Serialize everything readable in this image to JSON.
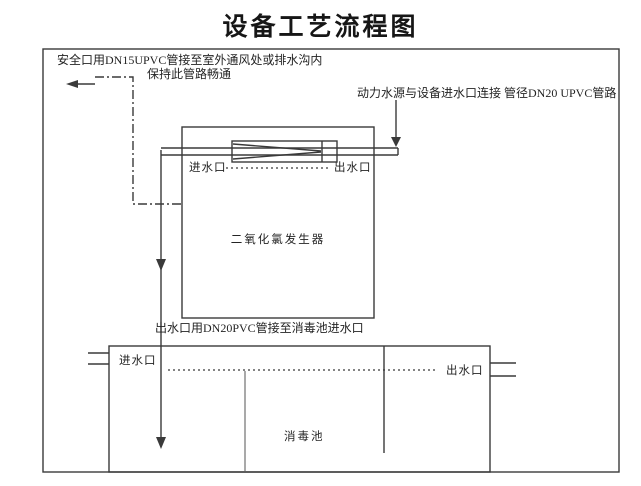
{
  "title": "设备工艺流程图",
  "annotations": {
    "safety_line1": "安全口用DN15UPVC管接至室外通风处或排水沟内",
    "safety_line2": "保持此管路畅通",
    "supply_line": "动力水源与设备进水口连接 管径DN20 UPVC管路",
    "outlet_pipe": "出水口用DN20PVC管接至消毒池进水口"
  },
  "generator": {
    "label": "二氧化氯发生器",
    "inlet_label": "进水口",
    "outlet_label": "出水口"
  },
  "pool": {
    "label": "消毒池",
    "inlet_label": "进水口",
    "outlet_label": "出水口"
  },
  "colors": {
    "line": "#3a3a3a",
    "baffle_gray": "#a9a9a9",
    "text": "#242424",
    "background": "#ffffff"
  }
}
